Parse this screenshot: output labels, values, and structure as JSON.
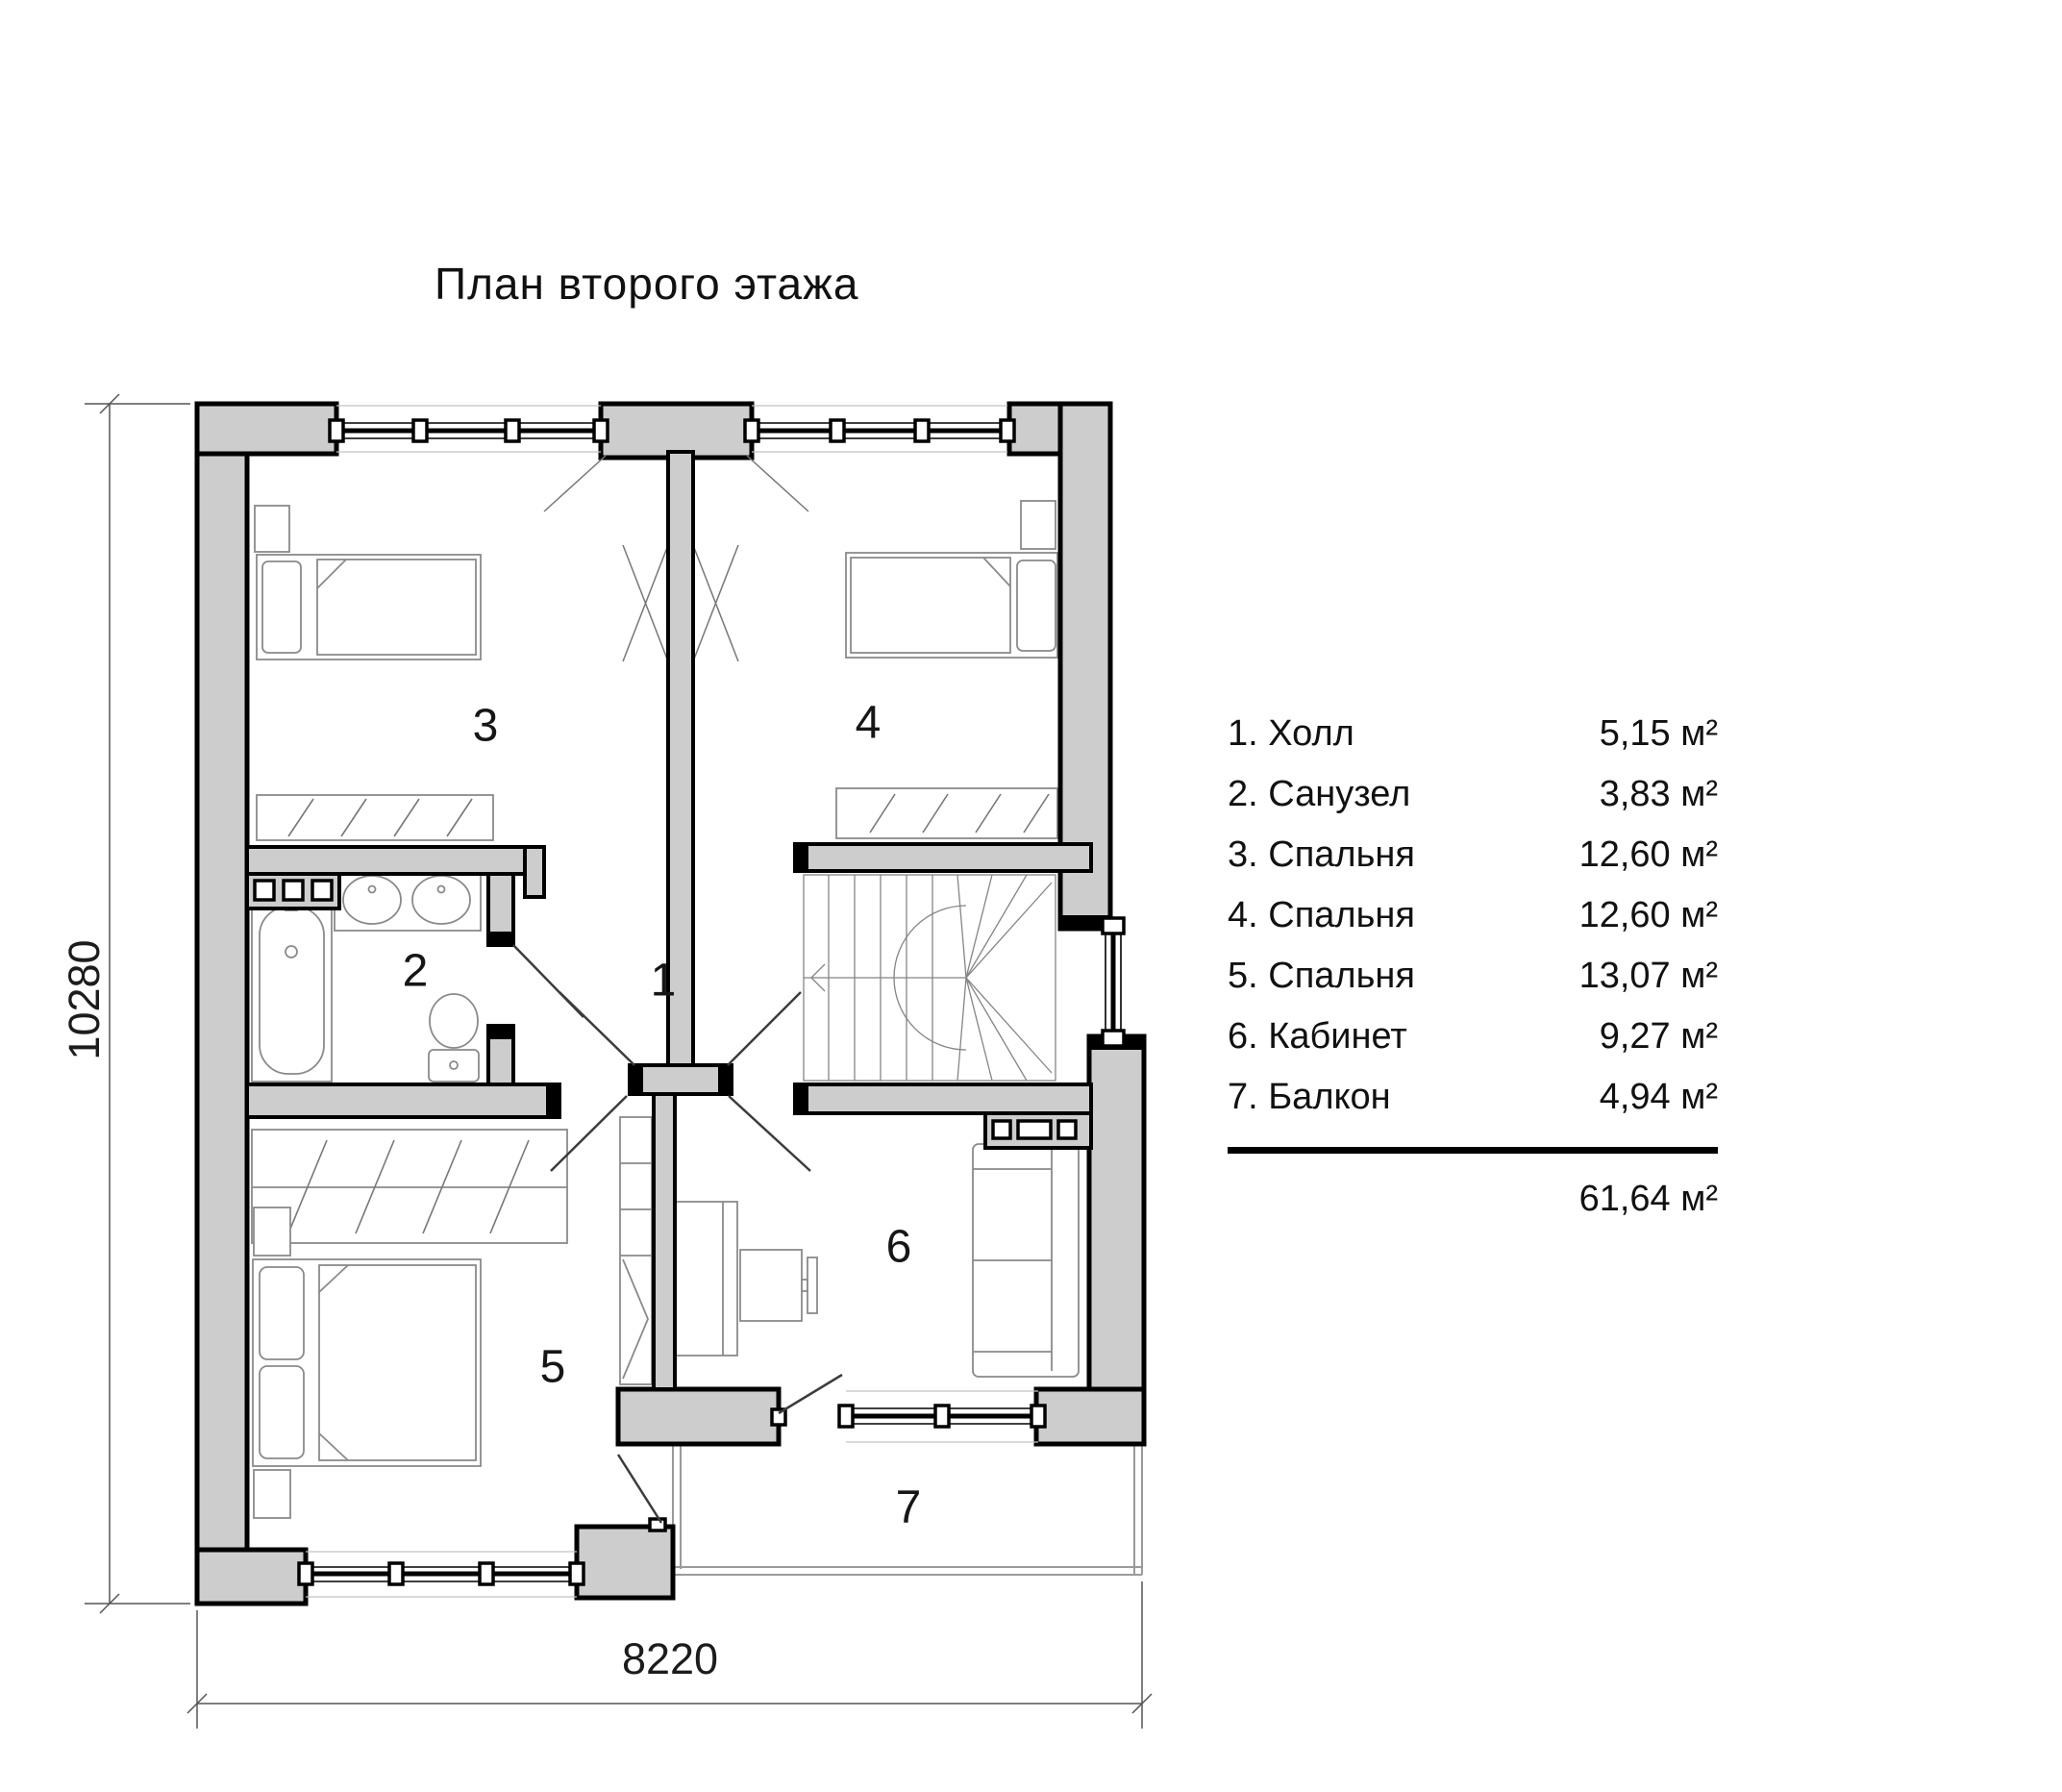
{
  "title": "План второго этажа",
  "legend": {
    "items": [
      {
        "label": "1. Холл",
        "area": "5,15 м²"
      },
      {
        "label": "2. Санузел",
        "area": "3,83 м²"
      },
      {
        "label": "3. Спальня",
        "area": "12,60 м²"
      },
      {
        "label": "4. Спальня",
        "area": "12,60 м²"
      },
      {
        "label": "5. Спальня",
        "area": "13,07 м²"
      },
      {
        "label": "6. Кабинет",
        "area": "9,27 м²"
      },
      {
        "label": "7. Балкон",
        "area": "4,94 м²"
      }
    ],
    "total_area": "61,64 м²"
  },
  "dimensions": {
    "width_mm": "8220",
    "height_mm": "10280"
  },
  "plan": {
    "room_numbers": [
      "1",
      "2",
      "3",
      "4",
      "5",
      "6",
      "7"
    ]
  },
  "colors": {
    "wall_fill": "#cdcdcd",
    "outline": "#000000",
    "furniture_line": "#8a8a8a"
  }
}
